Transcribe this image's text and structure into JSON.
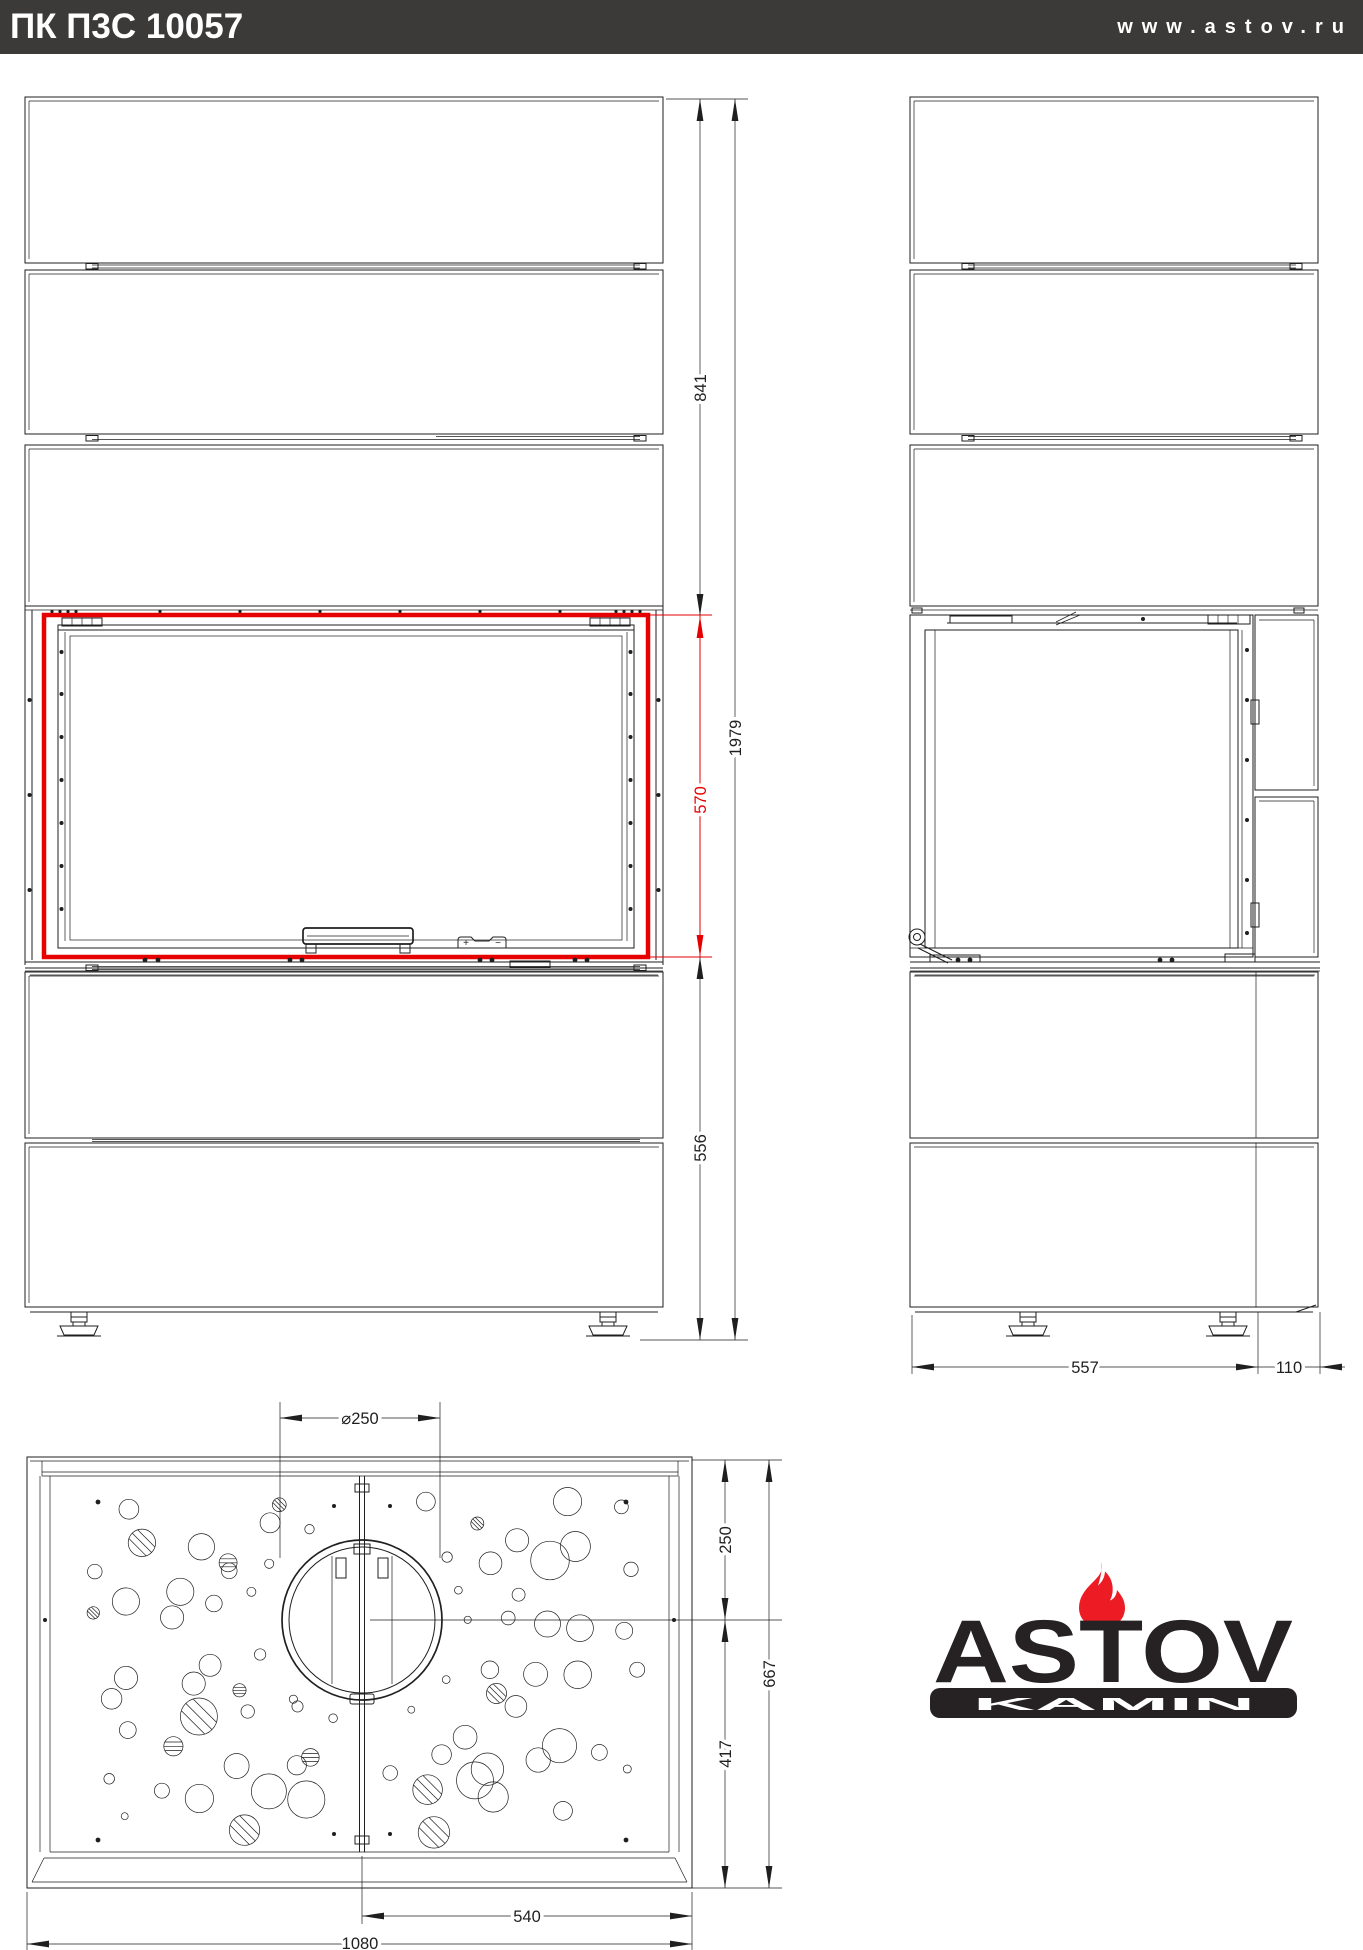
{
  "header": {
    "title": "ПК П3С 10057",
    "website": "www.astov.ru"
  },
  "colors": {
    "header_bg": "#3b3a39",
    "line": "#1f1f1f",
    "accent_red": "#e60000",
    "flame_red": "#ed1c24",
    "logo_dark": "#262223"
  },
  "views": {
    "front": {
      "dims": {
        "upper_height": "841",
        "overall_height": "1979",
        "firebox_height": "570",
        "lower_height": "556"
      },
      "controls": {
        "plus": "+",
        "minus": "−"
      }
    },
    "side": {
      "dims": {
        "body_depth": "557",
        "rear_depth": "110"
      }
    },
    "plan": {
      "dims": {
        "flue_diameter": "⌀250",
        "front_to_flue_center": "250",
        "overall_depth": "667",
        "flue_center_to_back": "417",
        "half_width": "540",
        "overall_width": "1080"
      }
    }
  },
  "logo": {
    "brand": "ASTOV",
    "subtitle": "KAMIN"
  }
}
